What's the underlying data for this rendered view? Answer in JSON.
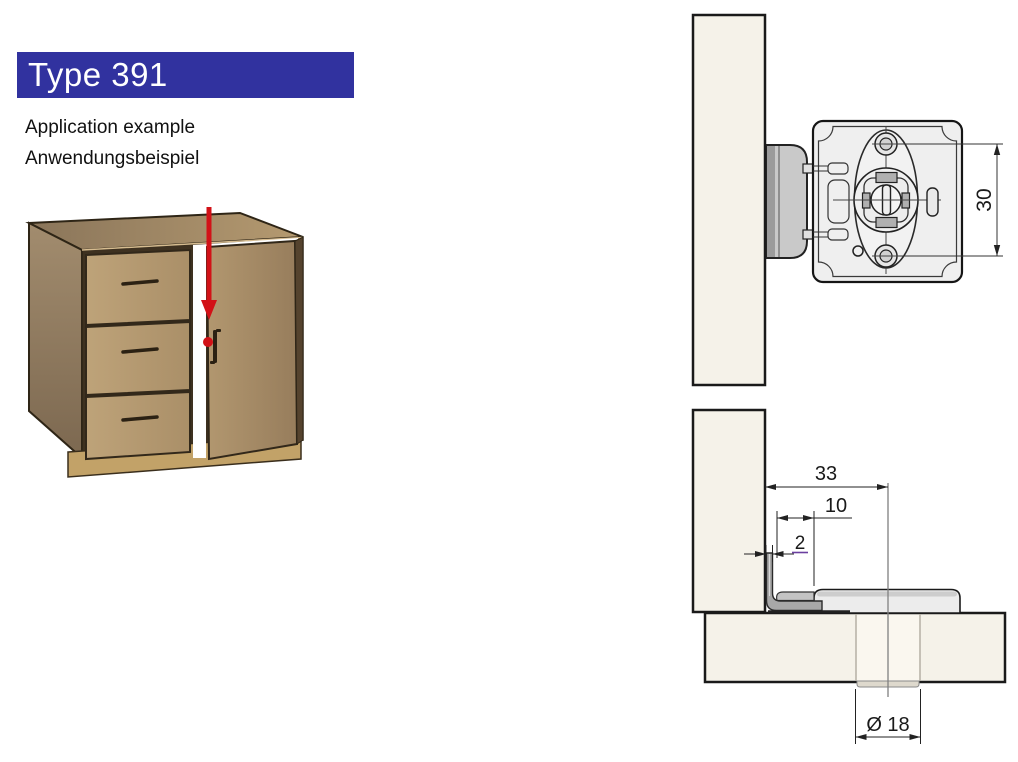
{
  "header": {
    "title": "Type 391"
  },
  "subtitle": {
    "line1": "Application example",
    "line2": "Anwendungsbeispiel"
  },
  "colors": {
    "header_bar": "#31329F",
    "header_text": "#FFFFFF",
    "arrow_red": "#D21117",
    "dim_purple": "#6B3FA0",
    "panel_cream": "#F5F2E9",
    "hardware_gray": "#ECECEC",
    "strike_gray": "#C9C9C9"
  },
  "front_view": {
    "dim_screw_spacing": "30"
  },
  "section_view": {
    "dim_backset": "33",
    "dim_housing_offset": "10",
    "dim_plate_thickness": "2",
    "dim_cylinder_diameter": "Ø 18"
  }
}
